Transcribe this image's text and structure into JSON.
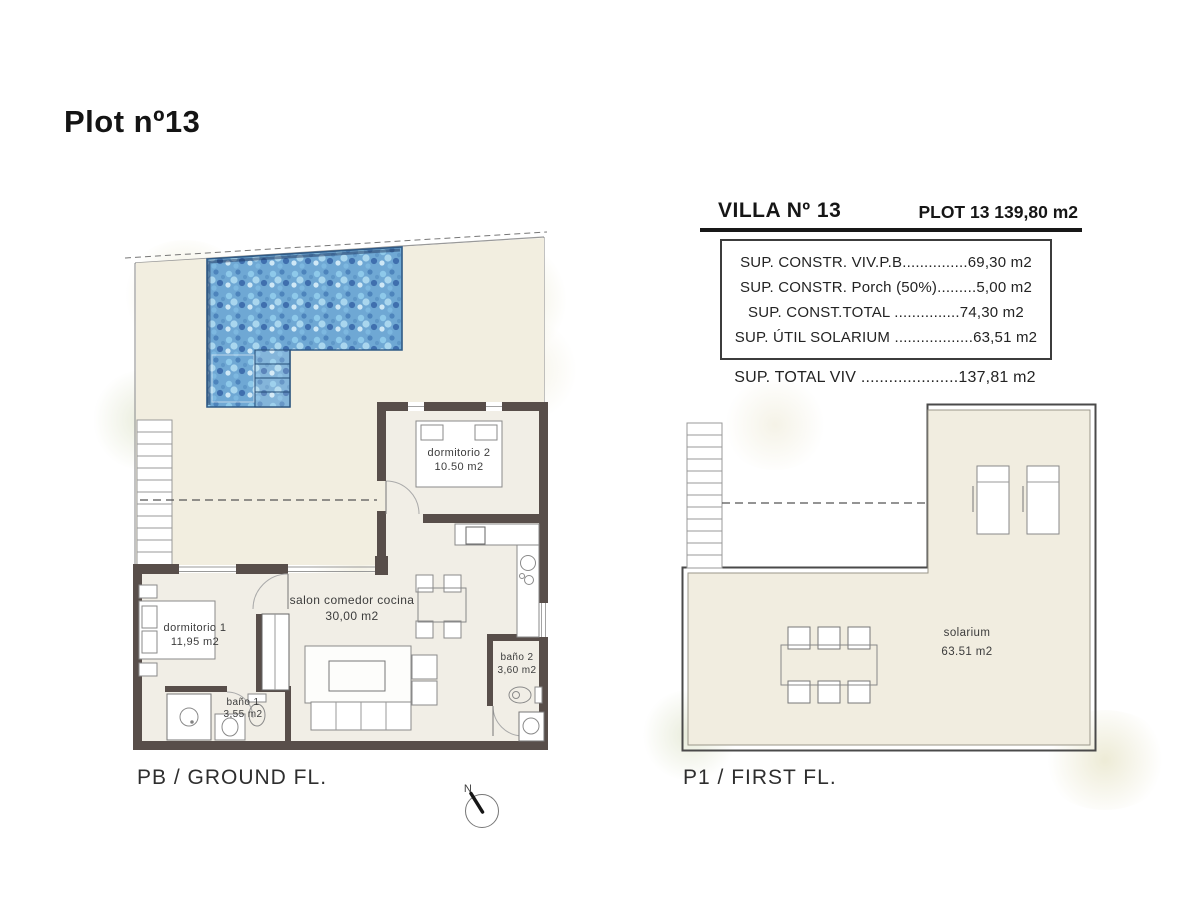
{
  "page": {
    "title": "Plot nº13"
  },
  "info_table": {
    "header": {
      "villa": "VILLA Nº 13",
      "plot": "PLOT 13 139,80 m2"
    },
    "rows": [
      {
        "label": "SUP. CONSTR. VIV.P.B",
        "leader": "...............",
        "value": "69,30 m2"
      },
      {
        "label": "SUP. CONSTR. Porch (50%)",
        "leader": ".........",
        "value": "5,00 m2"
      },
      {
        "label": "SUP. CONST.TOTAL ",
        "leader": "...............",
        "value": "74,30 m2"
      },
      {
        "label": "SUP. ÚTIL SOLARIUM ",
        "leader": "..................",
        "value": "63,51 m2"
      }
    ],
    "total": {
      "label": "SUP. TOTAL VIV ",
      "leader": ".....................",
      "value": "137,81 m2"
    }
  },
  "ground_floor": {
    "caption": "PB / GROUND FL.",
    "rooms": {
      "dormitorio2": {
        "name": "dormitorio 2",
        "area": "10.50 m2"
      },
      "dormitorio1": {
        "name": "dormitorio 1",
        "area": "11,95 m2"
      },
      "salon": {
        "name": "salon comedor cocina",
        "area": "30,00 m2"
      },
      "bano1": {
        "name": "baño 1",
        "area": "3,55 m2"
      },
      "bano2": {
        "name": "baño 2",
        "area": "3,60 m2"
      }
    }
  },
  "first_floor": {
    "caption": "P1 / FIRST FL.",
    "rooms": {
      "solarium": {
        "name": "solarium",
        "area": "63.51 m2"
      }
    }
  },
  "compass": {
    "label": "N"
  },
  "colors": {
    "wall": "#584e4a",
    "pool": "#5f9fd2",
    "pool_edge": "#2f5a86",
    "terrace_floor": "#f2eee0",
    "interior_floor": "#f1eee6",
    "line": "#999999"
  }
}
